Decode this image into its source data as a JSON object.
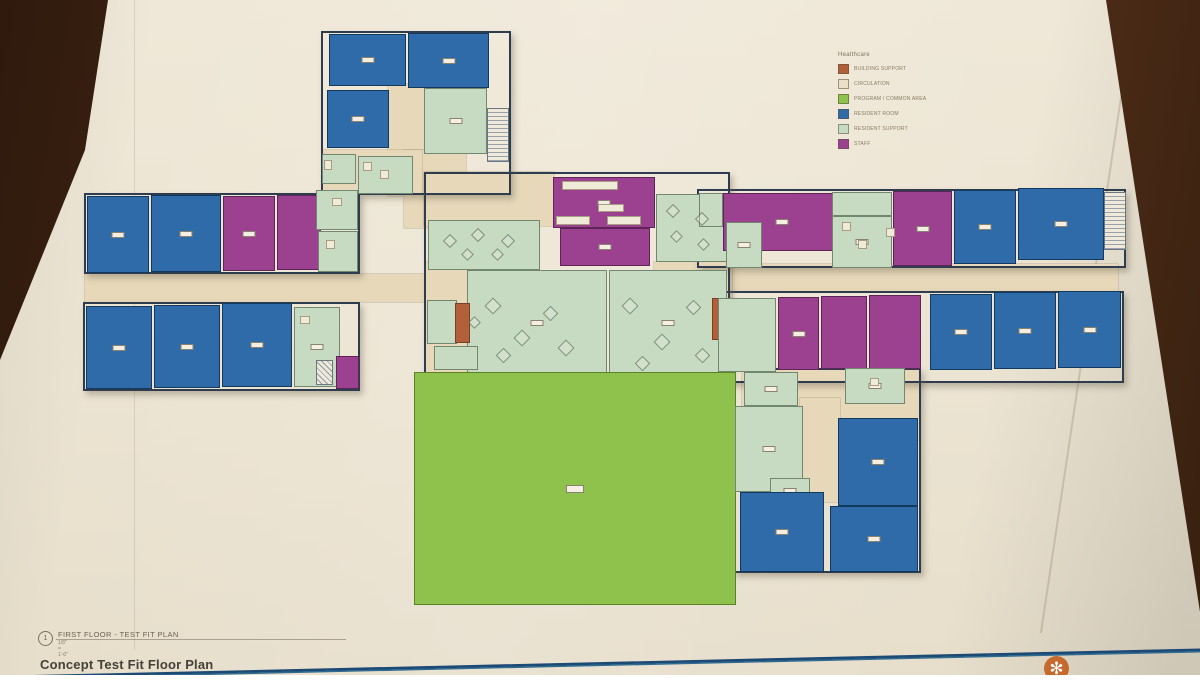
{
  "legend": {
    "title": "Healthcare",
    "items": [
      {
        "label": "BUILDING SUPPORT",
        "color": "#b2603a"
      },
      {
        "label": "CIRCULATION",
        "color": "#ecdfca"
      },
      {
        "label": "PROGRAM / COMMON AREA",
        "color": "#8fc24c"
      },
      {
        "label": "RESIDENT ROOM",
        "color": "#2f6ba8"
      },
      {
        "label": "RESIDENT SUPPORT",
        "color": "#c7dbc2"
      },
      {
        "label": "STAFF",
        "color": "#9c4190"
      }
    ]
  },
  "title_block": {
    "detail_number": "1",
    "title": "FIRST FLOOR - TEST FIT PLAN",
    "scale": "1/8\" = 1'-0\"",
    "sheet_name": "Concept Test Fit Floor Plan"
  },
  "plan": {
    "colors": {
      "blue": {
        "fill": "#2f6ba8",
        "edge": "#14395f"
      },
      "purple": {
        "fill": "#9c4190",
        "edge": "#5e2357"
      },
      "mint": {
        "fill": "#c7dbc2",
        "edge": "#72876f"
      },
      "green": {
        "fill": "#8fc24c",
        "edge": "#5c8228"
      },
      "orange": {
        "fill": "#b2603a",
        "edge": "#7a3f22"
      },
      "white": {
        "fill": "#f0ead9",
        "edge": "#a89d82"
      }
    },
    "corridors": [
      {
        "x": 388,
        "y": 84,
        "w": 36,
        "h": 112
      },
      {
        "x": 404,
        "y": 150,
        "w": 62,
        "h": 78
      },
      {
        "x": 85,
        "y": 274,
        "w": 356,
        "h": 28
      },
      {
        "x": 716,
        "y": 264,
        "w": 402,
        "h": 28
      },
      {
        "x": 424,
        "y": 172,
        "w": 130,
        "h": 54
      },
      {
        "x": 425,
        "y": 262,
        "w": 46,
        "h": 114
      },
      {
        "x": 654,
        "y": 262,
        "w": 78,
        "h": 42
      },
      {
        "x": 742,
        "y": 370,
        "w": 178,
        "h": 70
      },
      {
        "x": 800,
        "y": 398,
        "w": 40,
        "h": 104
      },
      {
        "x": 322,
        "y": 150,
        "w": 100,
        "h": 44
      }
    ],
    "outlines": [
      {
        "x": 321,
        "y": 31,
        "w": 190,
        "h": 164
      },
      {
        "x": 84,
        "y": 193,
        "w": 276,
        "h": 81
      },
      {
        "x": 83,
        "y": 302,
        "w": 277,
        "h": 89
      },
      {
        "x": 697,
        "y": 189,
        "w": 429,
        "h": 79
      },
      {
        "x": 716,
        "y": 291,
        "w": 408,
        "h": 92
      },
      {
        "x": 733,
        "y": 368,
        "w": 188,
        "h": 205
      },
      {
        "x": 424,
        "y": 172,
        "w": 306,
        "h": 204
      }
    ],
    "rooms": [
      {
        "x": 329,
        "y": 34,
        "w": 77,
        "h": 52,
        "t": "blue",
        "b": 1
      },
      {
        "x": 408,
        "y": 33,
        "w": 81,
        "h": 55,
        "t": "blue",
        "b": 1
      },
      {
        "x": 327,
        "y": 90,
        "w": 62,
        "h": 58,
        "t": "blue",
        "b": 1
      },
      {
        "x": 424,
        "y": 88,
        "w": 63,
        "h": 66,
        "t": "mint",
        "b": 1
      },
      {
        "x": 322,
        "y": 154,
        "w": 34,
        "h": 30,
        "t": "mint"
      },
      {
        "x": 358,
        "y": 156,
        "w": 55,
        "h": 38,
        "t": "mint"
      },
      {
        "x": 87,
        "y": 196,
        "w": 62,
        "h": 77,
        "t": "blue",
        "b": 1
      },
      {
        "x": 151,
        "y": 195,
        "w": 70,
        "h": 77,
        "t": "blue",
        "b": 1
      },
      {
        "x": 223,
        "y": 196,
        "w": 52,
        "h": 75,
        "t": "purple",
        "b": 1
      },
      {
        "x": 277,
        "y": 195,
        "w": 44,
        "h": 75,
        "t": "purple"
      },
      {
        "x": 316,
        "y": 190,
        "w": 42,
        "h": 40,
        "t": "mint"
      },
      {
        "x": 318,
        "y": 231,
        "w": 40,
        "h": 41,
        "t": "mint"
      },
      {
        "x": 86,
        "y": 306,
        "w": 66,
        "h": 83,
        "t": "blue",
        "b": 1
      },
      {
        "x": 154,
        "y": 305,
        "w": 66,
        "h": 83,
        "t": "blue",
        "b": 1
      },
      {
        "x": 222,
        "y": 303,
        "w": 70,
        "h": 84,
        "t": "blue",
        "b": 1
      },
      {
        "x": 294,
        "y": 307,
        "w": 46,
        "h": 80,
        "t": "mint",
        "b": 1
      },
      {
        "x": 336,
        "y": 356,
        "w": 23,
        "h": 33,
        "t": "purple"
      },
      {
        "x": 428,
        "y": 220,
        "w": 112,
        "h": 50,
        "t": "mint"
      },
      {
        "x": 553,
        "y": 177,
        "w": 102,
        "h": 51,
        "t": "purple",
        "b": 1
      },
      {
        "x": 560,
        "y": 228,
        "w": 90,
        "h": 38,
        "t": "purple",
        "b": 1
      },
      {
        "x": 656,
        "y": 194,
        "w": 72,
        "h": 68,
        "t": "mint"
      },
      {
        "x": 467,
        "y": 270,
        "w": 140,
        "h": 106,
        "t": "mint",
        "b": 1
      },
      {
        "x": 609,
        "y": 270,
        "w": 118,
        "h": 106,
        "t": "mint",
        "b": 1
      },
      {
        "x": 427,
        "y": 300,
        "w": 30,
        "h": 44,
        "t": "mint"
      },
      {
        "x": 434,
        "y": 346,
        "w": 44,
        "h": 24,
        "t": "mint"
      },
      {
        "x": 455,
        "y": 303,
        "w": 15,
        "h": 40,
        "t": "orange"
      },
      {
        "x": 712,
        "y": 298,
        "w": 15,
        "h": 42,
        "t": "orange"
      },
      {
        "x": 699,
        "y": 193,
        "w": 24,
        "h": 34,
        "t": "mint"
      },
      {
        "x": 723,
        "y": 193,
        "w": 118,
        "h": 58,
        "t": "purple",
        "b": 1
      },
      {
        "x": 726,
        "y": 222,
        "w": 36,
        "h": 46,
        "t": "mint",
        "b": 1
      },
      {
        "x": 832,
        "y": 192,
        "w": 60,
        "h": 24,
        "t": "mint"
      },
      {
        "x": 832,
        "y": 216,
        "w": 60,
        "h": 52,
        "t": "mint",
        "b": 1
      },
      {
        "x": 893,
        "y": 191,
        "w": 59,
        "h": 75,
        "t": "purple",
        "b": 1
      },
      {
        "x": 954,
        "y": 190,
        "w": 62,
        "h": 74,
        "t": "blue",
        "b": 1
      },
      {
        "x": 1018,
        "y": 188,
        "w": 86,
        "h": 72,
        "t": "blue",
        "b": 1
      },
      {
        "x": 718,
        "y": 298,
        "w": 58,
        "h": 74,
        "t": "mint"
      },
      {
        "x": 778,
        "y": 297,
        "w": 41,
        "h": 73,
        "t": "purple",
        "b": 1
      },
      {
        "x": 821,
        "y": 296,
        "w": 46,
        "h": 73,
        "t": "purple"
      },
      {
        "x": 869,
        "y": 295,
        "w": 52,
        "h": 74,
        "t": "purple"
      },
      {
        "x": 930,
        "y": 294,
        "w": 62,
        "h": 76,
        "t": "blue",
        "b": 1
      },
      {
        "x": 994,
        "y": 292,
        "w": 62,
        "h": 77,
        "t": "blue",
        "b": 1
      },
      {
        "x": 1058,
        "y": 291,
        "w": 63,
        "h": 77,
        "t": "blue",
        "b": 1
      },
      {
        "x": 414,
        "y": 372,
        "w": 322,
        "h": 233,
        "t": "green",
        "b": 1
      },
      {
        "x": 744,
        "y": 372,
        "w": 54,
        "h": 34,
        "t": "mint",
        "b": 1
      },
      {
        "x": 735,
        "y": 406,
        "w": 68,
        "h": 86,
        "t": "mint",
        "b": 1
      },
      {
        "x": 770,
        "y": 478,
        "w": 40,
        "h": 26,
        "t": "mint",
        "b": 1
      },
      {
        "x": 845,
        "y": 368,
        "w": 60,
        "h": 36,
        "t": "mint",
        "b": 1
      },
      {
        "x": 838,
        "y": 418,
        "w": 80,
        "h": 88,
        "t": "blue",
        "b": 1
      },
      {
        "x": 740,
        "y": 492,
        "w": 84,
        "h": 80,
        "t": "blue",
        "b": 1
      },
      {
        "x": 830,
        "y": 506,
        "w": 88,
        "h": 66,
        "t": "blue",
        "b": 1
      },
      {
        "x": 562,
        "y": 181,
        "w": 56,
        "h": 9,
        "t": "white"
      },
      {
        "x": 598,
        "y": 204,
        "w": 26,
        "h": 8,
        "t": "white"
      },
      {
        "x": 556,
        "y": 216,
        "w": 34,
        "h": 9,
        "t": "white"
      },
      {
        "x": 607,
        "y": 216,
        "w": 34,
        "h": 9,
        "t": "white"
      },
      {
        "x": 324,
        "y": 160,
        "w": 8,
        "h": 10,
        "t": "white"
      },
      {
        "x": 332,
        "y": 198,
        "w": 10,
        "h": 8,
        "t": "white"
      },
      {
        "x": 326,
        "y": 240,
        "w": 9,
        "h": 9,
        "t": "white"
      },
      {
        "x": 300,
        "y": 316,
        "w": 10,
        "h": 8,
        "t": "white"
      },
      {
        "x": 842,
        "y": 222,
        "w": 9,
        "h": 9,
        "t": "white"
      },
      {
        "x": 858,
        "y": 240,
        "w": 9,
        "h": 9,
        "t": "white"
      },
      {
        "x": 870,
        "y": 378,
        "w": 9,
        "h": 8,
        "t": "white"
      },
      {
        "x": 886,
        "y": 228,
        "w": 9,
        "h": 9,
        "t": "white"
      },
      {
        "x": 363,
        "y": 162,
        "w": 9,
        "h": 9,
        "t": "white"
      },
      {
        "x": 380,
        "y": 170,
        "w": 9,
        "h": 9,
        "t": "white"
      }
    ],
    "stairs": [
      {
        "x": 487,
        "y": 108,
        "w": 22,
        "h": 54
      },
      {
        "x": 1104,
        "y": 192,
        "w": 22,
        "h": 58
      }
    ],
    "hatches": [
      {
        "x": 316,
        "y": 360,
        "w": 17,
        "h": 25
      }
    ],
    "furniture": [
      {
        "x": 445,
        "y": 236,
        "s": 10
      },
      {
        "x": 473,
        "y": 230,
        "s": 10
      },
      {
        "x": 503,
        "y": 236,
        "s": 10
      },
      {
        "x": 463,
        "y": 250,
        "s": 9
      },
      {
        "x": 493,
        "y": 250,
        "s": 9
      },
      {
        "x": 668,
        "y": 206,
        "s": 10
      },
      {
        "x": 697,
        "y": 214,
        "s": 10
      },
      {
        "x": 672,
        "y": 232,
        "s": 9
      },
      {
        "x": 699,
        "y": 240,
        "s": 9
      },
      {
        "x": 487,
        "y": 300,
        "s": 12
      },
      {
        "x": 516,
        "y": 332,
        "s": 12
      },
      {
        "x": 545,
        "y": 308,
        "s": 11
      },
      {
        "x": 498,
        "y": 350,
        "s": 11
      },
      {
        "x": 560,
        "y": 342,
        "s": 12
      },
      {
        "x": 470,
        "y": 318,
        "s": 9
      },
      {
        "x": 624,
        "y": 300,
        "s": 12
      },
      {
        "x": 656,
        "y": 336,
        "s": 12
      },
      {
        "x": 688,
        "y": 302,
        "s": 11
      },
      {
        "x": 637,
        "y": 358,
        "s": 11
      },
      {
        "x": 697,
        "y": 350,
        "s": 11
      }
    ]
  }
}
